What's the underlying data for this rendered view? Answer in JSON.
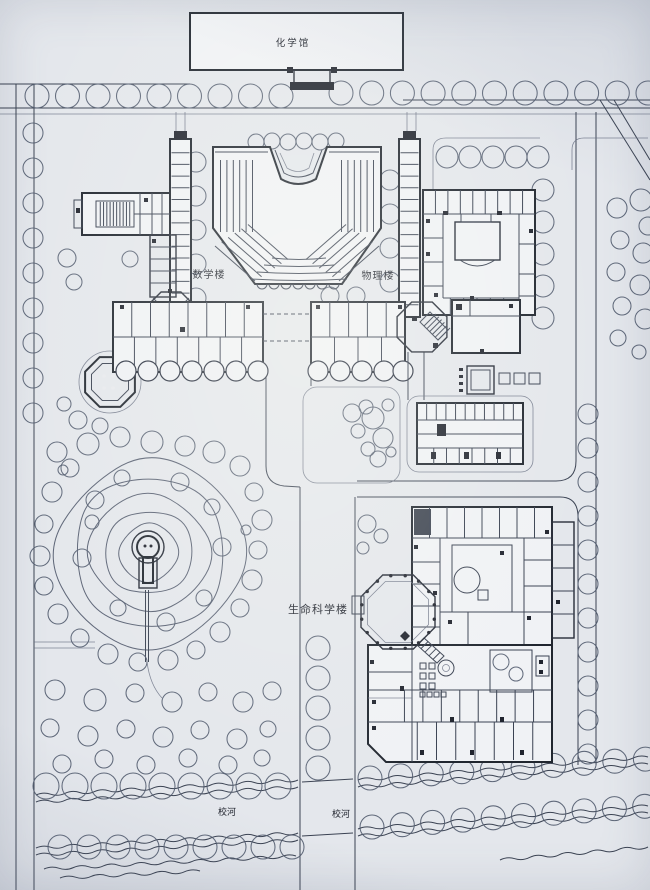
{
  "plan": {
    "labels": {
      "chemistry_hall": "化学馆",
      "math_building": "数学楼",
      "physics_building": "物理楼",
      "life_science_building": "生命科学楼",
      "river_left": "校河",
      "river_right": "校河"
    },
    "colors": {
      "paper": "#e4e7ec",
      "ink": "#20262f",
      "line": "#3a4252",
      "tree": "#515b6e",
      "building_fill": "#f0f2f5"
    }
  }
}
